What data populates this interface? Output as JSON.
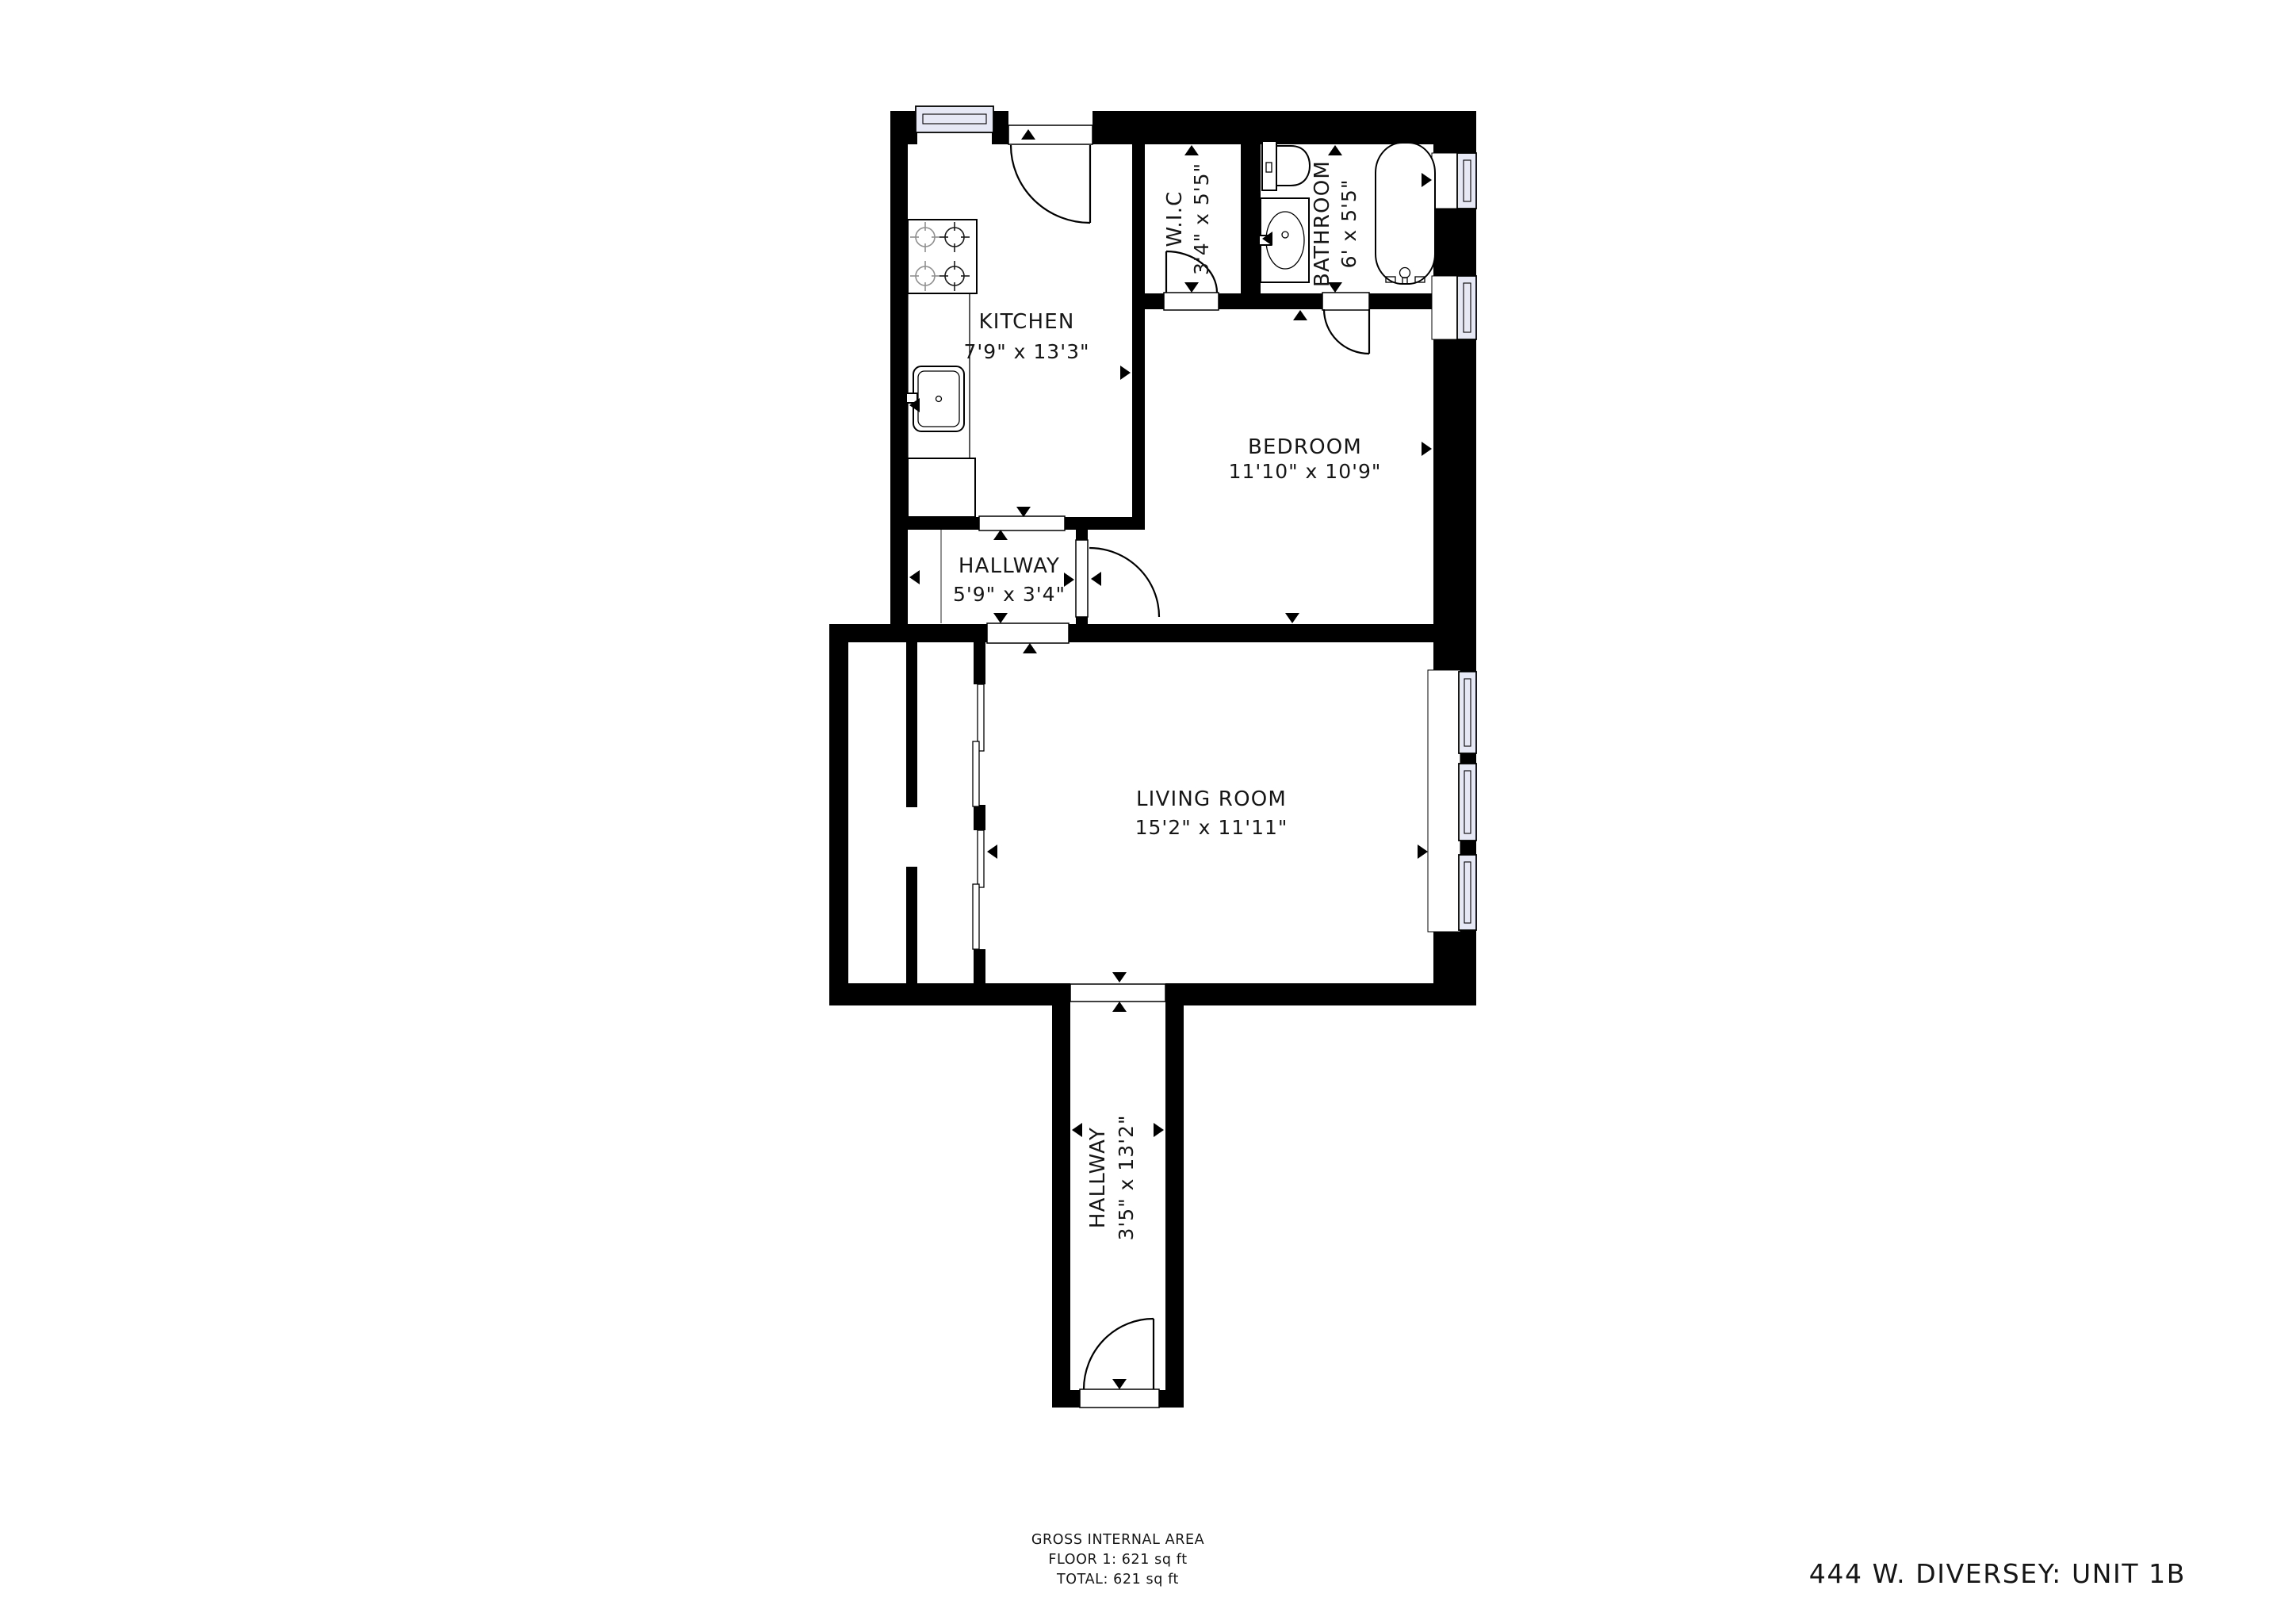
{
  "title": "444 W. DIVERSEY: UNIT 1B",
  "footer": {
    "line1": "GROSS INTERNAL AREA",
    "line2": "FLOOR 1: 621 sq ft",
    "line3": "TOTAL: 621 sq ft"
  },
  "rooms": {
    "kitchen": {
      "name": "KITCHEN",
      "dims": "7'9\" x 13'3\""
    },
    "wic": {
      "name": "W.I.C",
      "dims": "3'4\" x 5'5\""
    },
    "bathroom": {
      "name": "BATHROOM",
      "dims": "6' x 5'5\""
    },
    "bedroom": {
      "name": "BEDROOM",
      "dims": "11'10\" x 10'9\""
    },
    "hallway": {
      "name": "HALLWAY",
      "dims": "5'9\" x 3'4\""
    },
    "living_room": {
      "name": "LIVING ROOM",
      "dims": "15'2\" x 11'11\""
    },
    "entry_hallway": {
      "name": "HALLWAY",
      "dims": "3'5\" x 13'2\""
    }
  },
  "colors": {
    "wall": "#000000",
    "window_glass": "#e6e8f5",
    "text": "#161616"
  }
}
